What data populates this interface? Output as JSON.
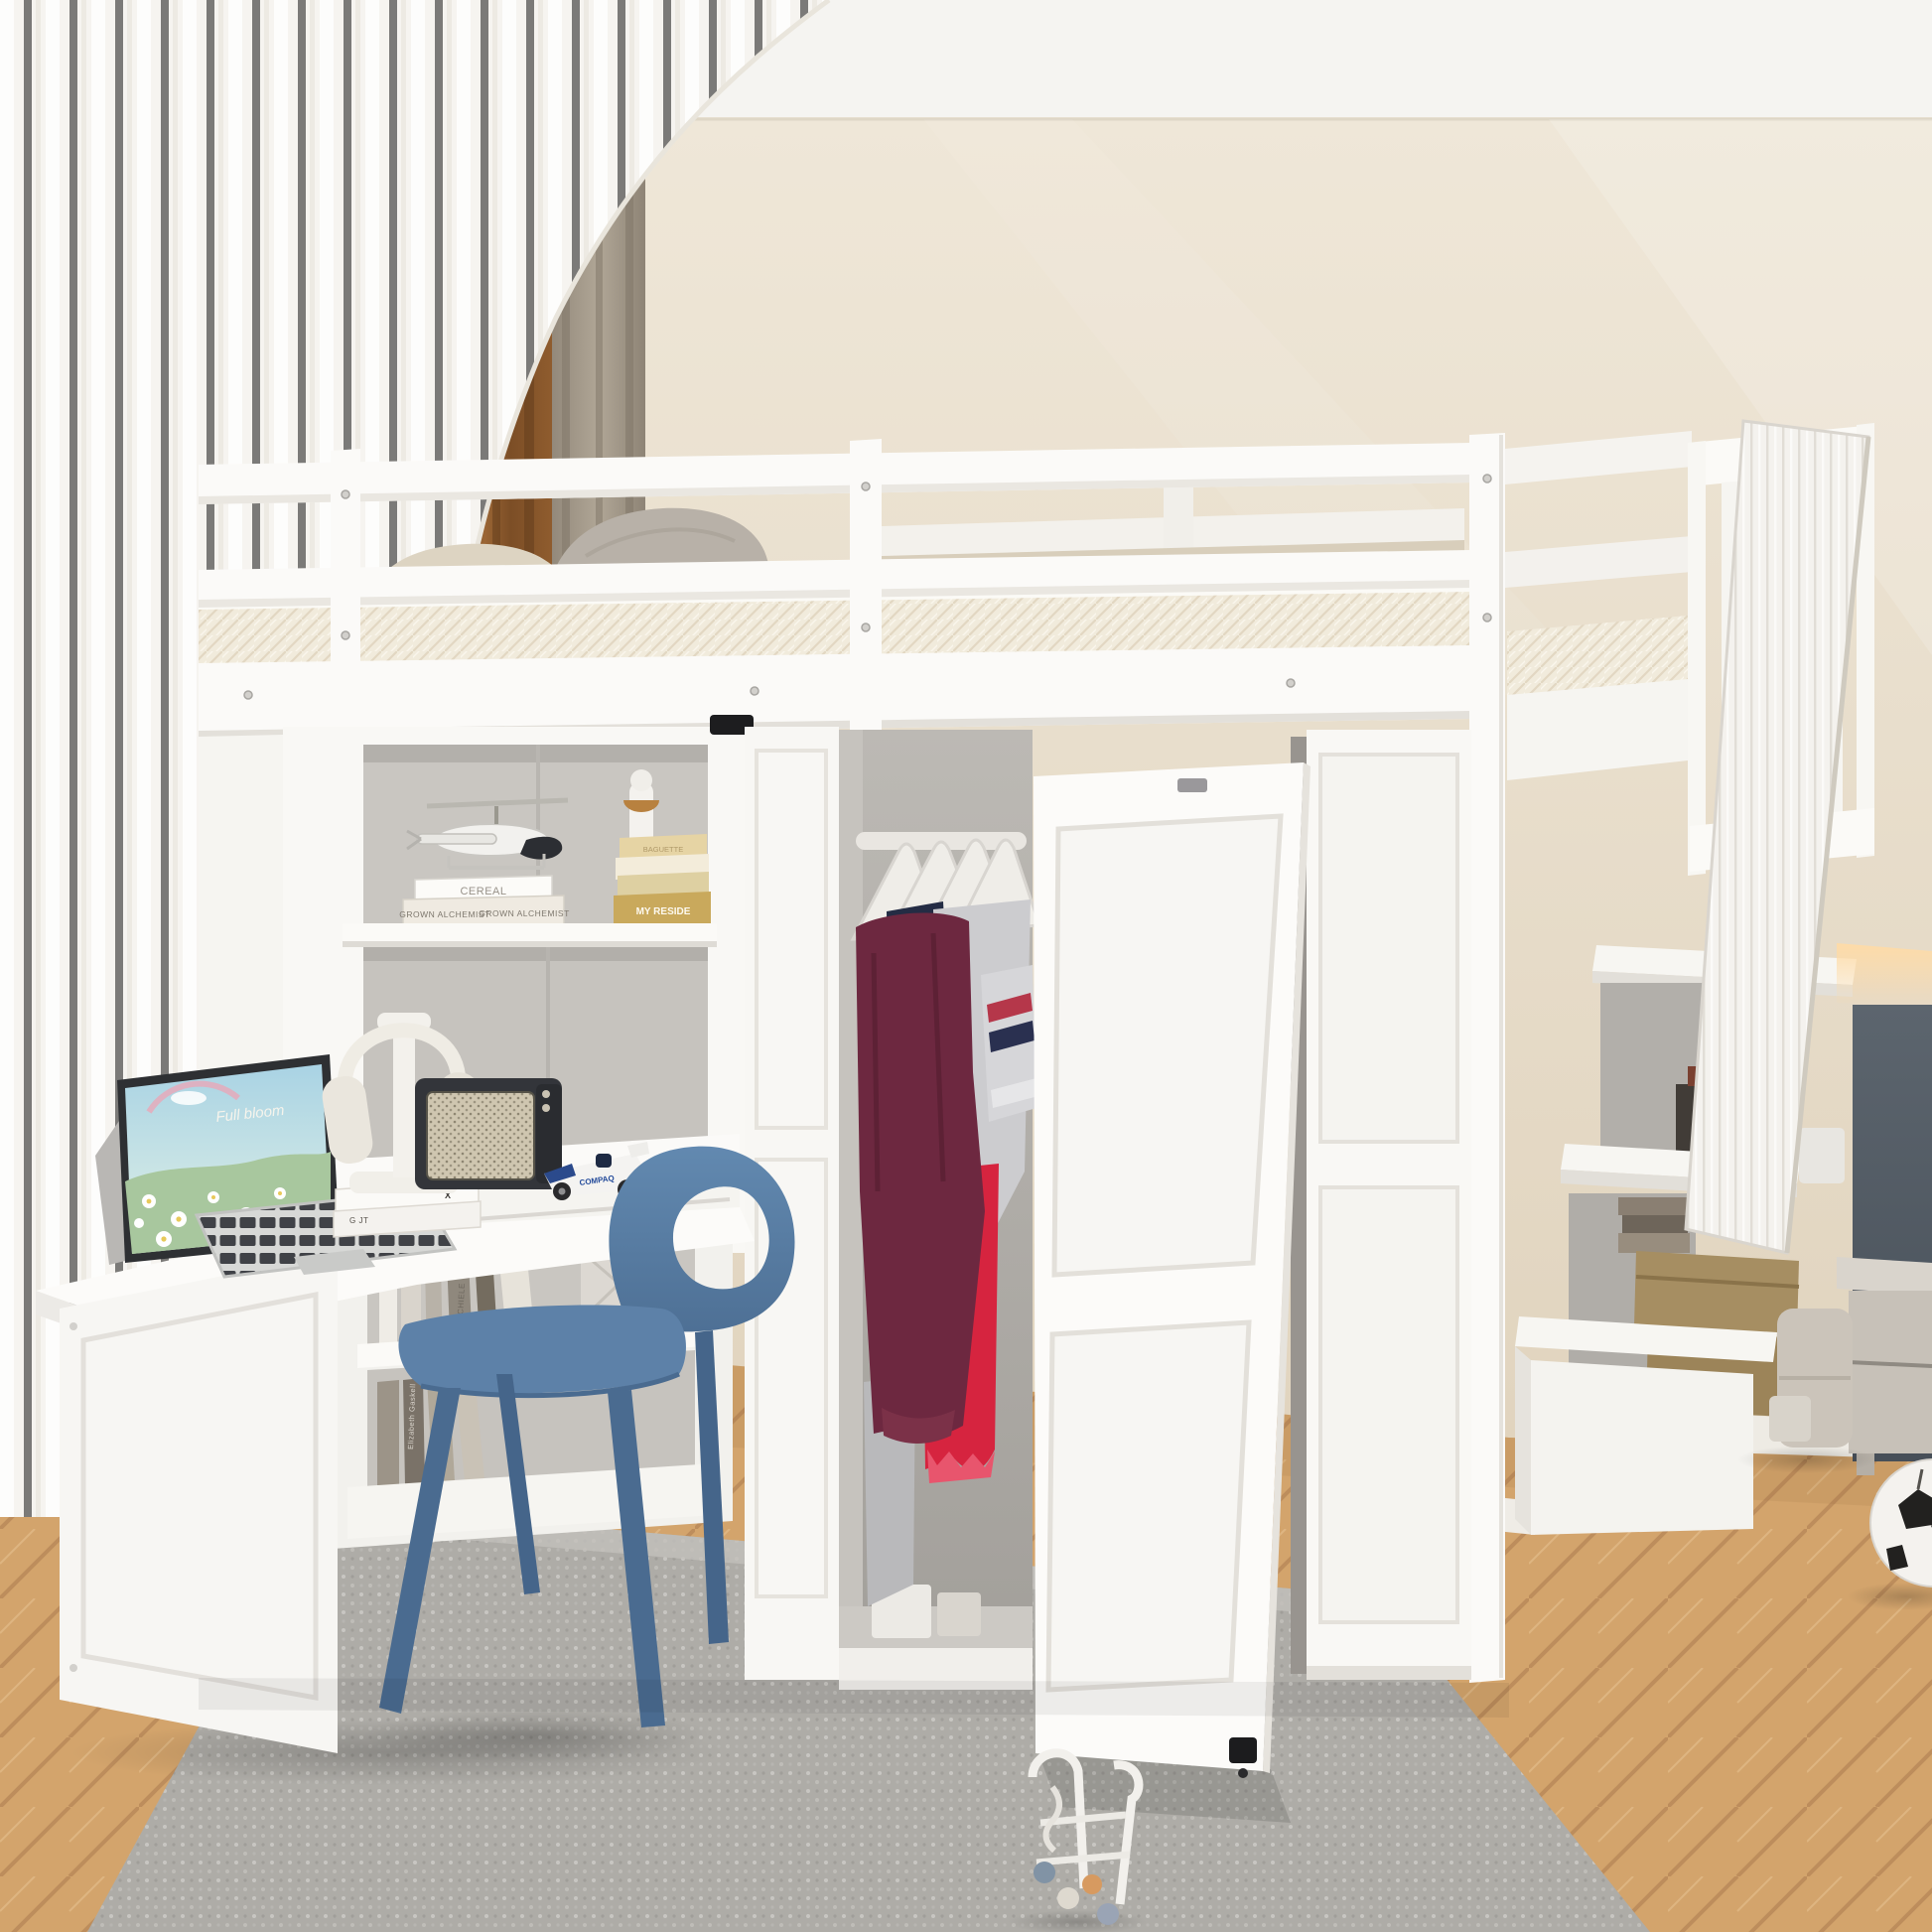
{
  "scene": {
    "description": "White loft bed with guard rails over a built-in desk, open wardrobe with clothes, and a storage staircase, in a beige bedroom with sheer and brown curtains, herringbone wood floor, gray rug, blue chair and a soccer ball."
  },
  "colors": {
    "ceiling": "#f5f4f1",
    "wall-top": "#efe7d8",
    "wall-bottom": "#e0d3bd",
    "sheer-curtain": "#f7f5f1",
    "brown-curtain": "#8a5a30",
    "taupe-curtain": "#a59a8b",
    "frame-white": "#fbfaf8",
    "frame-shade": "#f0eeea",
    "frame-edge": "#e2dfda",
    "mattress-cream": "#f1ebdc",
    "pillow-gray": "#b8b1a8",
    "pillow-beige": "#ddd4c2",
    "duvet-beige": "#d8cebb",
    "interior-gray": "#c7c4bf",
    "wardrobe-gray": "#b5b2ad",
    "clothes-maroon": "#6d2840",
    "clothes-gray": "#cccccf",
    "clothes-red": "#d6243f",
    "clothes-navy": "#242c44",
    "pants-gray": "#b9b9bb",
    "chair-blue": "#5d81a8",
    "chair-blue-dark": "#4a6b90",
    "rug-gray": "#b4b2ad",
    "wood": "#d3a46c",
    "wood-seam": "#bd8d5c",
    "speaker-body": "#33353a",
    "speaker-grille": "#cfc6b0",
    "slate-cabinet": "#525b64",
    "warm-glow": "#ffd9a0",
    "gold-book": "#c9a95c",
    "khaki-box": "#a68e62",
    "ball-black": "#22211f",
    "toy-wood-orange": "#d79a60"
  },
  "decor": {
    "laptop_wallpaper_text": "Full bloom",
    "shelf_books": [
      "CEREAL",
      "GROWN ALCHEMIST",
      "GROWN ALCHEMIST"
    ],
    "gold_books": [
      "BAGUETTE",
      "MY RESIDE"
    ],
    "desk_books_text": "G JT",
    "desk_books_logo": "X",
    "car_brand": "COMPAQ",
    "under_desk_spines": [
      "SCHIELE",
      "Elizabeth Gaskell"
    ]
  },
  "objects": [
    "loft-bed",
    "guard-rail",
    "mattress",
    "pillows",
    "storage-staircase",
    "stair-railing",
    "wardrobe",
    "hangers",
    "clothes",
    "wardrobe-door",
    "shelf-tower",
    "toy-helicopter",
    "figurine",
    "desk",
    "laptop",
    "headphones",
    "speaker",
    "toy-race-car",
    "bookshelf",
    "blue-chair",
    "rug",
    "wood-floor",
    "soccer-ball",
    "push-walker-toy",
    "nightstand",
    "pouf",
    "sheer-curtain",
    "brown-curtain"
  ]
}
